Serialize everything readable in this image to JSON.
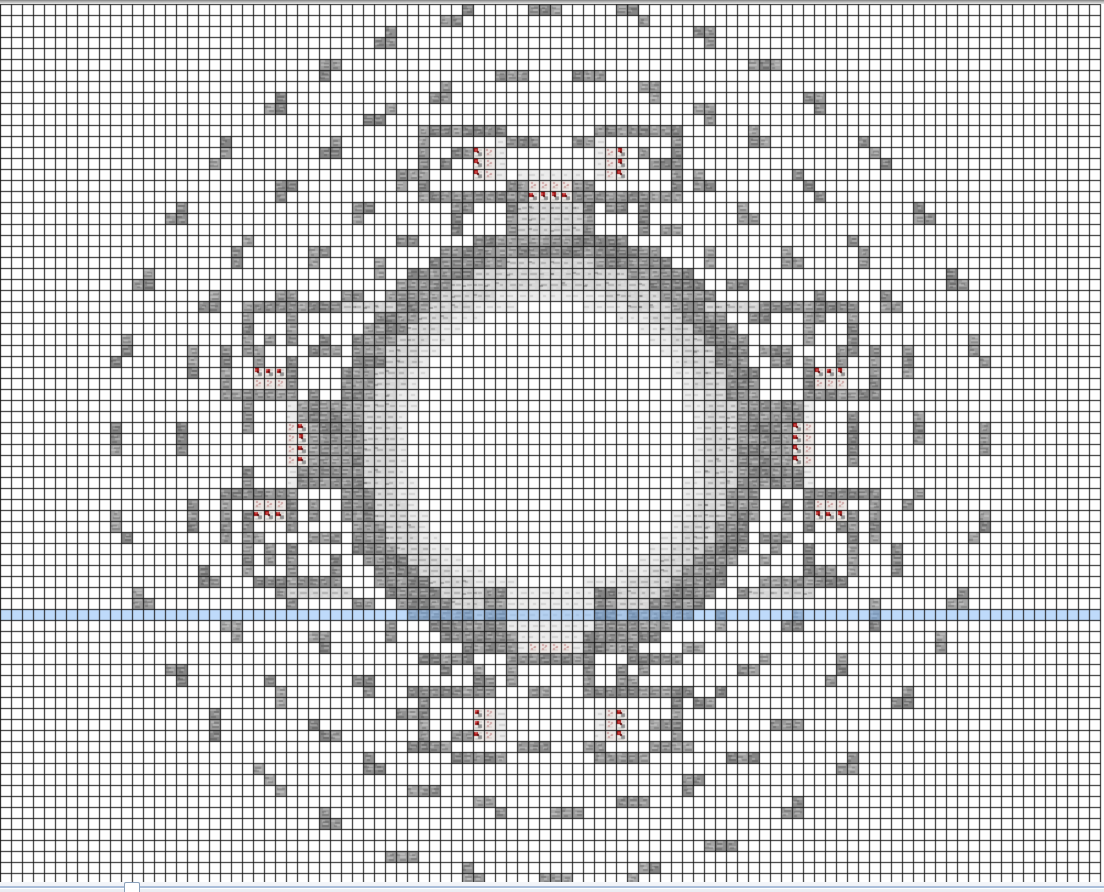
{
  "app": {
    "title": "structure-grid-view",
    "description": "Top-down block grid plan of a circular structure with eight torch rooms, dotted guide circles, water level row and horizontal scrollbar"
  },
  "canvas": {
    "width": 1104,
    "height": 892
  },
  "grid": {
    "cols": 100,
    "rows": 80,
    "cell_px": 11,
    "offset_x": 0,
    "offset_y": 4,
    "line_color": "#121212",
    "bg": "#ffffff"
  },
  "palette": {
    "stone": "#9b9b9b",
    "stone_light_streak": "#bcbcbc",
    "stone_dark_streak": "#767676",
    "light": "#d6d6d6",
    "verylight": "#ebebeb",
    "torch_base": "#f2efec",
    "torch_red": "#a51515",
    "torch_red_bright": "#d34848",
    "torch_red_dark": "#570909",
    "torch_pink": "#cfa3a3",
    "water": "rgba(125,182,246,0.5)",
    "top_bar": "#9a9a9a",
    "scroll_track": "#eef1f6",
    "scroll_groove": "#a9bdd9",
    "scroll_thumb_border": "#8aa0ba"
  },
  "tile_codes": {
    "S": "stone",
    "L": "light",
    "V": "verylight",
    "R": "torch_red",
    "P": "torch_pink"
  },
  "structure": {
    "center": {
      "col": 50.0,
      "row": 40.0
    },
    "ring_bands": [
      {
        "r0": 16.95,
        "r1": 19.95,
        "t": "S"
      },
      {
        "r0": 14.45,
        "r1": 16.95,
        "t": "L"
      },
      {
        "r0": 12.95,
        "r1": 14.45,
        "t": "V"
      }
    ],
    "guide_arcs": [
      {
        "r": 22.4,
        "on": 2,
        "off": 3,
        "phase": 0.3
      },
      {
        "r": 27.5,
        "on": 3,
        "off": 3,
        "phase": 0.0
      },
      {
        "r": 33.4,
        "on": 3,
        "off": 4,
        "phase": 0.15
      },
      {
        "r": 39.8,
        "on": 3,
        "off": 5,
        "phase": 0.45
      }
    ],
    "rects": [
      [
        "V",
        47,
        15,
        52,
        15
      ],
      [
        "S",
        46,
        16,
        46,
        20
      ],
      [
        "S",
        53,
        16,
        53,
        20
      ],
      [
        "S",
        47,
        16,
        47,
        17
      ],
      [
        "S",
        52,
        16,
        52,
        17
      ],
      [
        "P",
        48,
        16,
        51,
        16
      ],
      [
        "R",
        48,
        17,
        51,
        17
      ],
      [
        "L",
        47,
        18,
        52,
        20
      ],
      [
        "S",
        38,
        11,
        45,
        11
      ],
      [
        "S",
        38,
        12,
        38,
        16
      ],
      [
        "V",
        45,
        12,
        45,
        15
      ],
      [
        "R",
        43,
        13,
        43,
        15
      ],
      [
        "P",
        44,
        13,
        44,
        15
      ],
      [
        "S",
        38,
        17,
        45,
        17
      ],
      [
        "S",
        46,
        17,
        46,
        19
      ],
      [
        "S",
        41,
        18,
        41,
        20
      ],
      [
        "S",
        54,
        11,
        61,
        11
      ],
      [
        "S",
        61,
        12,
        61,
        16
      ],
      [
        "V",
        54,
        12,
        54,
        15
      ],
      [
        "P",
        55,
        13,
        55,
        15
      ],
      [
        "R",
        56,
        13,
        56,
        15
      ],
      [
        "S",
        54,
        17,
        61,
        17
      ],
      [
        "S",
        53,
        17,
        53,
        19
      ],
      [
        "S",
        58,
        18,
        58,
        20
      ],
      [
        "S",
        22,
        27,
        30,
        27
      ],
      [
        "L",
        31,
        27,
        35,
        27
      ],
      [
        "S",
        22,
        28,
        22,
        31
      ],
      [
        "S",
        26,
        28,
        26,
        30
      ],
      [
        "S",
        28,
        31,
        30,
        31
      ],
      [
        "R",
        23,
        33,
        25,
        33
      ],
      [
        "P",
        23,
        34,
        25,
        34
      ],
      [
        "S",
        20,
        31,
        20,
        35
      ],
      [
        "S",
        21,
        35,
        26,
        35
      ],
      [
        "S",
        26,
        32,
        26,
        34
      ],
      [
        "S",
        69,
        27,
        77,
        27
      ],
      [
        "L",
        64,
        27,
        68,
        27
      ],
      [
        "S",
        77,
        28,
        77,
        31
      ],
      [
        "S",
        73,
        28,
        73,
        30
      ],
      [
        "S",
        69,
        31,
        71,
        31
      ],
      [
        "R",
        74,
        33,
        76,
        33
      ],
      [
        "P",
        74,
        34,
        76,
        34
      ],
      [
        "S",
        79,
        31,
        79,
        35
      ],
      [
        "S",
        73,
        35,
        78,
        35
      ],
      [
        "S",
        73,
        32,
        73,
        34
      ],
      [
        "V",
        26,
        36,
        26,
        43
      ],
      [
        "P",
        26,
        38,
        26,
        41
      ],
      [
        "R",
        27,
        38,
        27,
        41
      ],
      [
        "S",
        27,
        36,
        27,
        37
      ],
      [
        "S",
        27,
        42,
        27,
        43
      ],
      [
        "S",
        28,
        36,
        28,
        43
      ],
      [
        "S",
        29,
        36,
        29,
        43
      ],
      [
        "V",
        73,
        36,
        73,
        43
      ],
      [
        "P",
        73,
        38,
        73,
        41
      ],
      [
        "R",
        72,
        38,
        72,
        41
      ],
      [
        "S",
        72,
        36,
        72,
        37
      ],
      [
        "S",
        72,
        42,
        72,
        43
      ],
      [
        "S",
        71,
        36,
        71,
        43
      ],
      [
        "S",
        70,
        36,
        70,
        43
      ],
      [
        "S",
        23,
        52,
        30,
        52
      ],
      [
        "L",
        26,
        53,
        31,
        53
      ],
      [
        "S",
        22,
        46,
        22,
        51
      ],
      [
        "S",
        26,
        49,
        26,
        51
      ],
      [
        "S",
        28,
        48,
        30,
        48
      ],
      [
        "P",
        23,
        45,
        25,
        45
      ],
      [
        "R",
        23,
        46,
        25,
        46
      ],
      [
        "S",
        20,
        44,
        20,
        48
      ],
      [
        "S",
        21,
        44,
        26,
        44
      ],
      [
        "S",
        26,
        45,
        26,
        47
      ],
      [
        "S",
        69,
        52,
        76,
        52
      ],
      [
        "L",
        68,
        53,
        73,
        53
      ],
      [
        "S",
        77,
        46,
        77,
        51
      ],
      [
        "S",
        73,
        49,
        73,
        51
      ],
      [
        "S",
        69,
        48,
        71,
        48
      ],
      [
        "P",
        74,
        45,
        76,
        45
      ],
      [
        "R",
        74,
        46,
        76,
        46
      ],
      [
        "S",
        79,
        44,
        79,
        48
      ],
      [
        "S",
        73,
        44,
        78,
        44
      ],
      [
        "S",
        73,
        45,
        73,
        47
      ],
      [
        "V",
        46,
        53,
        53,
        58
      ],
      [
        "P",
        48,
        58,
        51,
        58
      ],
      [
        "S",
        44,
        53,
        45,
        56
      ],
      [
        "S",
        54,
        53,
        55,
        56
      ],
      [
        "S",
        43,
        57,
        46,
        57
      ],
      [
        "S",
        53,
        57,
        56,
        57
      ],
      [
        "S",
        42,
        58,
        46,
        58
      ],
      [
        "S",
        53,
        58,
        57,
        58
      ],
      [
        "S",
        38,
        59,
        42,
        59
      ],
      [
        "S",
        57,
        59,
        61,
        59
      ],
      [
        "S",
        43,
        60,
        43,
        61
      ],
      [
        "S",
        56,
        60,
        56,
        61
      ],
      [
        "S",
        37,
        62,
        44,
        62
      ],
      [
        "S",
        38,
        63,
        38,
        67
      ],
      [
        "V",
        45,
        64,
        45,
        66
      ],
      [
        "R",
        43,
        64,
        43,
        66
      ],
      [
        "P",
        44,
        64,
        44,
        66
      ],
      [
        "S",
        41,
        68,
        45,
        68
      ],
      [
        "S",
        37,
        67,
        40,
        67
      ],
      [
        "S",
        46,
        60,
        46,
        61
      ],
      [
        "S",
        55,
        62,
        62,
        62
      ],
      [
        "S",
        61,
        63,
        61,
        67
      ],
      [
        "V",
        54,
        64,
        54,
        66
      ],
      [
        "P",
        55,
        64,
        55,
        66
      ],
      [
        "R",
        56,
        64,
        56,
        66
      ],
      [
        "S",
        54,
        68,
        58,
        68
      ],
      [
        "S",
        59,
        67,
        62,
        67
      ],
      [
        "S",
        53,
        60,
        53,
        61
      ]
    ],
    "water_row": 55
  },
  "scrollbar": {
    "thumb_x": 124,
    "thumb_w": 16,
    "track_y": 882,
    "track_h": 10
  }
}
